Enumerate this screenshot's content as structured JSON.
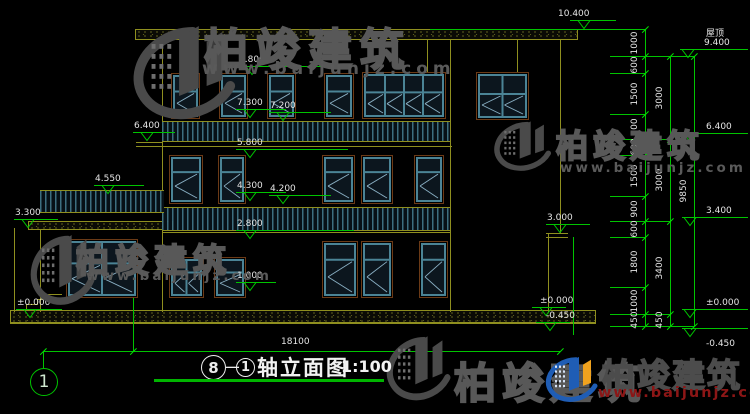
{
  "colors": {
    "yellow": "#8f8f1f",
    "green": "#00c400",
    "cyan": "#4b8496",
    "trim": "#6b3a16",
    "glass": "#0c161e",
    "diag": "#8ab0c4",
    "text": "#e4e4e4",
    "watermark_gray": "#4a4a4a",
    "logo_blue": "#1f5db5",
    "logo_orange": "#f0a21e",
    "logo_url_red": "#8c1616"
  },
  "watermark": {
    "brand": "柏竣建筑",
    "url": "www.baijunjz.com"
  },
  "brand_logo": {
    "brand": "柏竣建筑",
    "url": "www.baijunjz.com"
  },
  "title_block": {
    "axis_from": "8",
    "dash": "—",
    "axis_to": "1",
    "name": "轴立面图",
    "scale": "1:100"
  },
  "axis_bubble": {
    "label": "1"
  },
  "overall_dimension": {
    "label": "18100"
  },
  "roof_label": "屋顶",
  "elevation_marks": [
    {
      "t": "10.400",
      "tx": 584,
      "ty": 29,
      "lw": 46,
      "txo": -26
    },
    {
      "t": "8.800",
      "tx": 252,
      "ty": 75,
      "lw": 108
    },
    {
      "t": "7.300",
      "tx": 250,
      "ty": 118,
      "lw": 50
    },
    {
      "t": "7.200",
      "tx": 283,
      "ty": 121,
      "lw": 62
    },
    {
      "t": "6.400",
      "tx": 147,
      "ty": 141,
      "lw": 42
    },
    {
      "t": "5.800",
      "tx": 250,
      "ty": 158,
      "lw": 112
    },
    {
      "t": "4.550",
      "tx": 108,
      "ty": 194,
      "lw": 50
    },
    {
      "t": "4.300",
      "tx": 250,
      "ty": 201,
      "lw": 50
    },
    {
      "t": "4.200",
      "tx": 283,
      "ty": 204,
      "lw": 62
    },
    {
      "t": "3.300",
      "tx": 28,
      "ty": 228,
      "lw": 44
    },
    {
      "t": "3.000",
      "tx": 560,
      "ty": 233,
      "lw": 44
    },
    {
      "t": "2.800",
      "tx": 250,
      "ty": 239,
      "lw": 118
    },
    {
      "t": "1.000",
      "tx": 250,
      "ty": 291,
      "lw": 40
    },
    {
      "t": "±0.000",
      "tx": 30,
      "ty": 318,
      "lw": 46
    },
    {
      "t": "±0.000",
      "tx": 546,
      "ty": 316,
      "lw": 34,
      "txo": -6
    },
    {
      "t": "-0.450",
      "tx": 550,
      "ty": 331,
      "lw": 34,
      "txo": -4
    },
    {
      "t": "9.400",
      "t2": "屋顶",
      "tx": 688,
      "ty": 58,
      "lr": 1
    },
    {
      "t": "6.400",
      "tx": 690,
      "ty": 142,
      "lr": 1
    },
    {
      "t": "3.400",
      "tx": 690,
      "ty": 226,
      "lr": 1
    },
    {
      "t": "±0.000",
      "tx": 690,
      "ty": 318,
      "lr": 1
    },
    {
      "t": "-0.450",
      "tx": 690,
      "ty": 337,
      "lr": 1,
      "below": 1
    }
  ],
  "dim_chains": [
    {
      "x": 645,
      "ticks": [
        29,
        56,
        73,
        114,
        139,
        155,
        196,
        221,
        237,
        287,
        314,
        326
      ],
      "labels": [
        "1000",
        "600",
        "1500",
        "900",
        "600",
        "1500",
        "900",
        "600",
        "1800",
        "1000",
        "450"
      ]
    },
    {
      "x": 670,
      "ticks": [
        56,
        139,
        221,
        314,
        326
      ],
      "labels": [
        "3000",
        "3000",
        "3400",
        "450"
      ]
    },
    {
      "x": 694,
      "ticks": [
        56,
        326
      ],
      "labels": [
        "9850"
      ]
    }
  ],
  "green_hlines": [
    [
      430,
      29,
      215
    ],
    [
      610,
      56,
      84
    ],
    [
      610,
      73,
      35
    ],
    [
      610,
      114,
      35
    ],
    [
      610,
      139,
      60
    ],
    [
      610,
      155,
      35
    ],
    [
      610,
      196,
      35
    ],
    [
      610,
      221,
      60
    ],
    [
      610,
      237,
      35
    ],
    [
      610,
      287,
      35
    ],
    [
      610,
      314,
      60
    ],
    [
      610,
      326,
      84
    ]
  ],
  "green_vlines": [
    [
      573,
      237,
      98
    ],
    [
      133,
      298,
      54
    ],
    [
      43,
      352,
      16
    ]
  ],
  "dim_line": {
    "y": 351,
    "x1": 43,
    "x2": 560,
    "ticks": [
      43,
      133,
      560
    ],
    "label_x": 281,
    "label_y": 337
  },
  "drawing": {
    "slabs": [
      [
        135,
        29,
        443,
        11
      ],
      [
        28,
        221,
        145,
        9
      ],
      [
        10,
        310,
        586,
        13
      ]
    ],
    "walls": [
      [
        162,
        40,
        272
      ],
      [
        450,
        40,
        272
      ],
      [
        560,
        40,
        193
      ],
      [
        548,
        233,
        79
      ],
      [
        40,
        230,
        82
      ],
      [
        427,
        40,
        33
      ],
      [
        517,
        40,
        33
      ],
      [
        14,
        228,
        84
      ]
    ],
    "hlines": [
      [
        136,
        142,
        27
      ],
      [
        136,
        146,
        316
      ],
      [
        162,
        232,
        289
      ],
      [
        546,
        233,
        22
      ],
      [
        546,
        237,
        22
      ],
      [
        10,
        323,
        586
      ]
    ],
    "railings": [
      [
        162,
        121,
        288,
        21
      ],
      [
        162,
        207,
        288,
        24
      ],
      [
        40,
        190,
        124,
        23
      ]
    ],
    "steps": [
      [
        48,
        294,
        14,
        6
      ],
      [
        37,
        299,
        12,
        6
      ],
      [
        26,
        304,
        12,
        7
      ]
    ],
    "windows": [
      [
        172,
        74,
        27,
        44,
        1,
        0.38
      ],
      [
        220,
        74,
        27,
        44,
        1,
        0.38
      ],
      [
        268,
        74,
        27,
        44,
        1,
        0.38
      ],
      [
        325,
        74,
        28,
        44,
        1,
        0.38
      ],
      [
        363,
        73,
        82,
        45,
        4,
        0.42
      ],
      [
        477,
        73,
        51,
        46,
        2,
        0.45
      ],
      [
        170,
        156,
        32,
        47,
        1,
        0.32
      ],
      [
        219,
        156,
        26,
        47,
        1,
        0.32
      ],
      [
        323,
        156,
        31,
        47,
        1,
        0.32
      ],
      [
        362,
        156,
        30,
        47,
        1,
        0.32
      ],
      [
        415,
        156,
        28,
        47,
        1,
        0.32
      ],
      [
        170,
        258,
        33,
        39,
        2,
        0.35
      ],
      [
        215,
        258,
        30,
        39,
        1,
        0.35
      ],
      [
        323,
        242,
        34,
        55,
        1,
        0.3
      ],
      [
        362,
        242,
        30,
        55,
        1,
        0.3
      ],
      [
        420,
        242,
        27,
        55,
        1,
        0.3
      ],
      [
        67,
        240,
        70,
        57,
        2,
        0.4
      ]
    ]
  }
}
